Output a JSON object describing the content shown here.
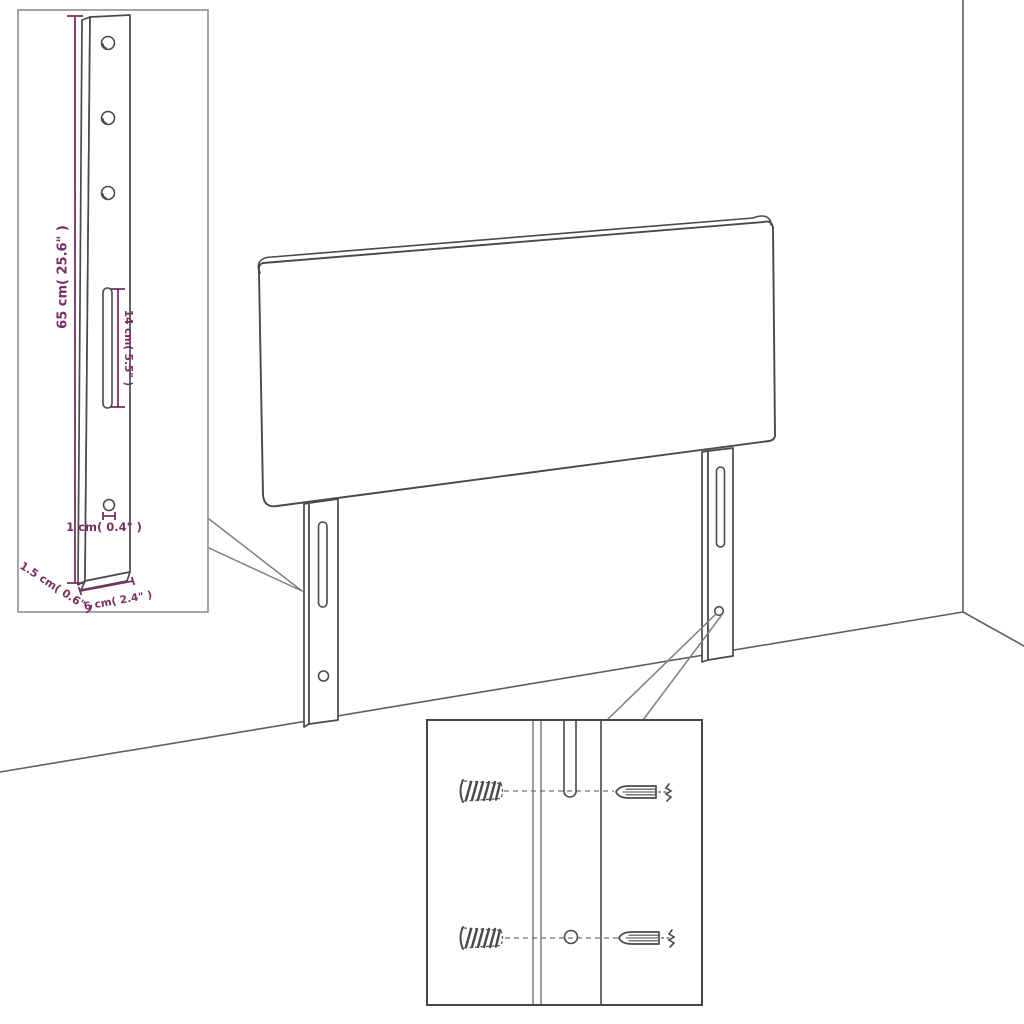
{
  "colors": {
    "dimension_color": "#7a2d63",
    "line_color": "#4a4a4a",
    "room_line_color": "#5f5f5f",
    "background": "#ffffff"
  },
  "insets": {
    "bracket_detail": {
      "dim_height": "65 cm( 25.6\" )",
      "dim_slot_length": "14 cm( 5.5\" )",
      "dim_hole": "1 cm( 0.4\" )",
      "dim_depth": "1.5 cm( 0.6\" )",
      "dim_width": "6 cm( 2.4\" )"
    }
  }
}
